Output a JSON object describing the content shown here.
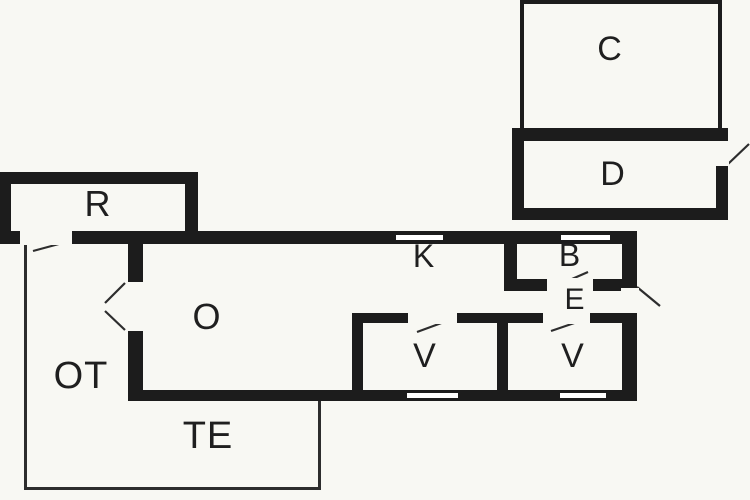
{
  "drawing": {
    "type": "floor-plan",
    "background": "#f8f8f3",
    "wall_color": "#1c1c1c",
    "line_color": "#2d2d2d",
    "label_color": "#1f1f1f"
  },
  "rooms": [
    {
      "id": "c",
      "label": "C",
      "cx": 610,
      "cy": 49,
      "fs": 34
    },
    {
      "id": "d",
      "label": "D",
      "cx": 613,
      "cy": 174,
      "fs": 34
    },
    {
      "id": "r",
      "label": "R",
      "cx": 98,
      "cy": 204,
      "fs": 36
    },
    {
      "id": "k",
      "label": "K",
      "cx": 424,
      "cy": 256,
      "fs": 32
    },
    {
      "id": "b",
      "label": "B",
      "cx": 570,
      "cy": 255,
      "fs": 32
    },
    {
      "id": "e",
      "label": "E",
      "cx": 575,
      "cy": 300,
      "fs": 30
    },
    {
      "id": "o",
      "label": "O",
      "cx": 207,
      "cy": 317,
      "fs": 36
    },
    {
      "id": "ot",
      "label": "OT",
      "cx": 81,
      "cy": 376,
      "fs": 38
    },
    {
      "id": "v1",
      "label": "V",
      "cx": 425,
      "cy": 356,
      "fs": 34
    },
    {
      "id": "v2",
      "label": "V",
      "cx": 573,
      "cy": 356,
      "fs": 34
    },
    {
      "id": "te",
      "label": "TE",
      "cx": 208,
      "cy": 436,
      "fs": 38
    }
  ],
  "geometry": {
    "walls": [
      {
        "x": 0,
        "y": 172,
        "w": 198,
        "h": 12
      },
      {
        "x": 0,
        "y": 172,
        "w": 11,
        "h": 72
      },
      {
        "x": 185,
        "y": 172,
        "w": 13,
        "h": 72
      },
      {
        "x": 0,
        "y": 231,
        "w": 637,
        "h": 13
      },
      {
        "x": 128,
        "y": 244,
        "w": 15,
        "h": 156
      },
      {
        "x": 128,
        "y": 390,
        "w": 509,
        "h": 11
      },
      {
        "x": 622,
        "y": 231,
        "w": 15,
        "h": 170
      },
      {
        "x": 504,
        "y": 244,
        "w": 13,
        "h": 47
      },
      {
        "x": 504,
        "y": 279,
        "w": 133,
        "h": 12
      },
      {
        "x": 352,
        "y": 313,
        "w": 285,
        "h": 10
      },
      {
        "x": 352,
        "y": 313,
        "w": 11,
        "h": 88
      },
      {
        "x": 497,
        "y": 313,
        "w": 11,
        "h": 88
      },
      {
        "x": 512,
        "y": 128,
        "w": 216,
        "h": 13
      },
      {
        "x": 512,
        "y": 128,
        "w": 12,
        "h": 92
      },
      {
        "x": 512,
        "y": 208,
        "w": 216,
        "h": 12
      },
      {
        "x": 716,
        "y": 128,
        "w": 12,
        "h": 92
      },
      {
        "x": 520,
        "y": 0,
        "w": 4,
        "h": 128
      },
      {
        "x": 520,
        "y": 0,
        "w": 202,
        "h": 4
      },
      {
        "x": 718,
        "y": 0,
        "w": 4,
        "h": 130
      }
    ],
    "thin_lines": [
      {
        "x": 24,
        "y": 244,
        "w": 3,
        "h": 246
      },
      {
        "x": 24,
        "y": 487,
        "w": 297,
        "h": 3
      },
      {
        "x": 318,
        "y": 401,
        "w": 3,
        "h": 89
      }
    ],
    "door_gaps": [
      {
        "x": 20,
        "y": 230,
        "w": 52,
        "h": 15
      },
      {
        "x": 126,
        "y": 282,
        "w": 19,
        "h": 49
      },
      {
        "x": 547,
        "y": 278,
        "w": 46,
        "h": 14
      },
      {
        "x": 621,
        "y": 288,
        "w": 18,
        "h": 25
      },
      {
        "x": 715,
        "y": 141,
        "w": 14,
        "h": 25
      },
      {
        "x": 408,
        "y": 312,
        "w": 49,
        "h": 12
      },
      {
        "x": 543,
        "y": 312,
        "w": 47,
        "h": 12
      }
    ],
    "windows": [
      {
        "x": 394,
        "y": 233,
        "w": 51,
        "h": 9
      },
      {
        "x": 559,
        "y": 233,
        "w": 53,
        "h": 9
      },
      {
        "x": 405,
        "y": 391,
        "w": 55,
        "h": 9
      },
      {
        "x": 558,
        "y": 391,
        "w": 50,
        "h": 9
      }
    ],
    "door_swings": [
      {
        "x1": 70,
        "y1": 241,
        "x2": 33,
        "y2": 251
      },
      {
        "x1": 125,
        "y1": 283,
        "x2": 105,
        "y2": 303
      },
      {
        "x1": 125,
        "y1": 330,
        "x2": 105,
        "y2": 311
      },
      {
        "x1": 549,
        "y1": 289,
        "x2": 588,
        "y2": 272
      },
      {
        "x1": 637,
        "y1": 287,
        "x2": 660,
        "y2": 306
      },
      {
        "x1": 417,
        "y1": 332,
        "x2": 455,
        "y2": 318
      },
      {
        "x1": 551,
        "y1": 331,
        "x2": 589,
        "y2": 318
      },
      {
        "x1": 728,
        "y1": 164,
        "x2": 749,
        "y2": 144
      }
    ]
  }
}
